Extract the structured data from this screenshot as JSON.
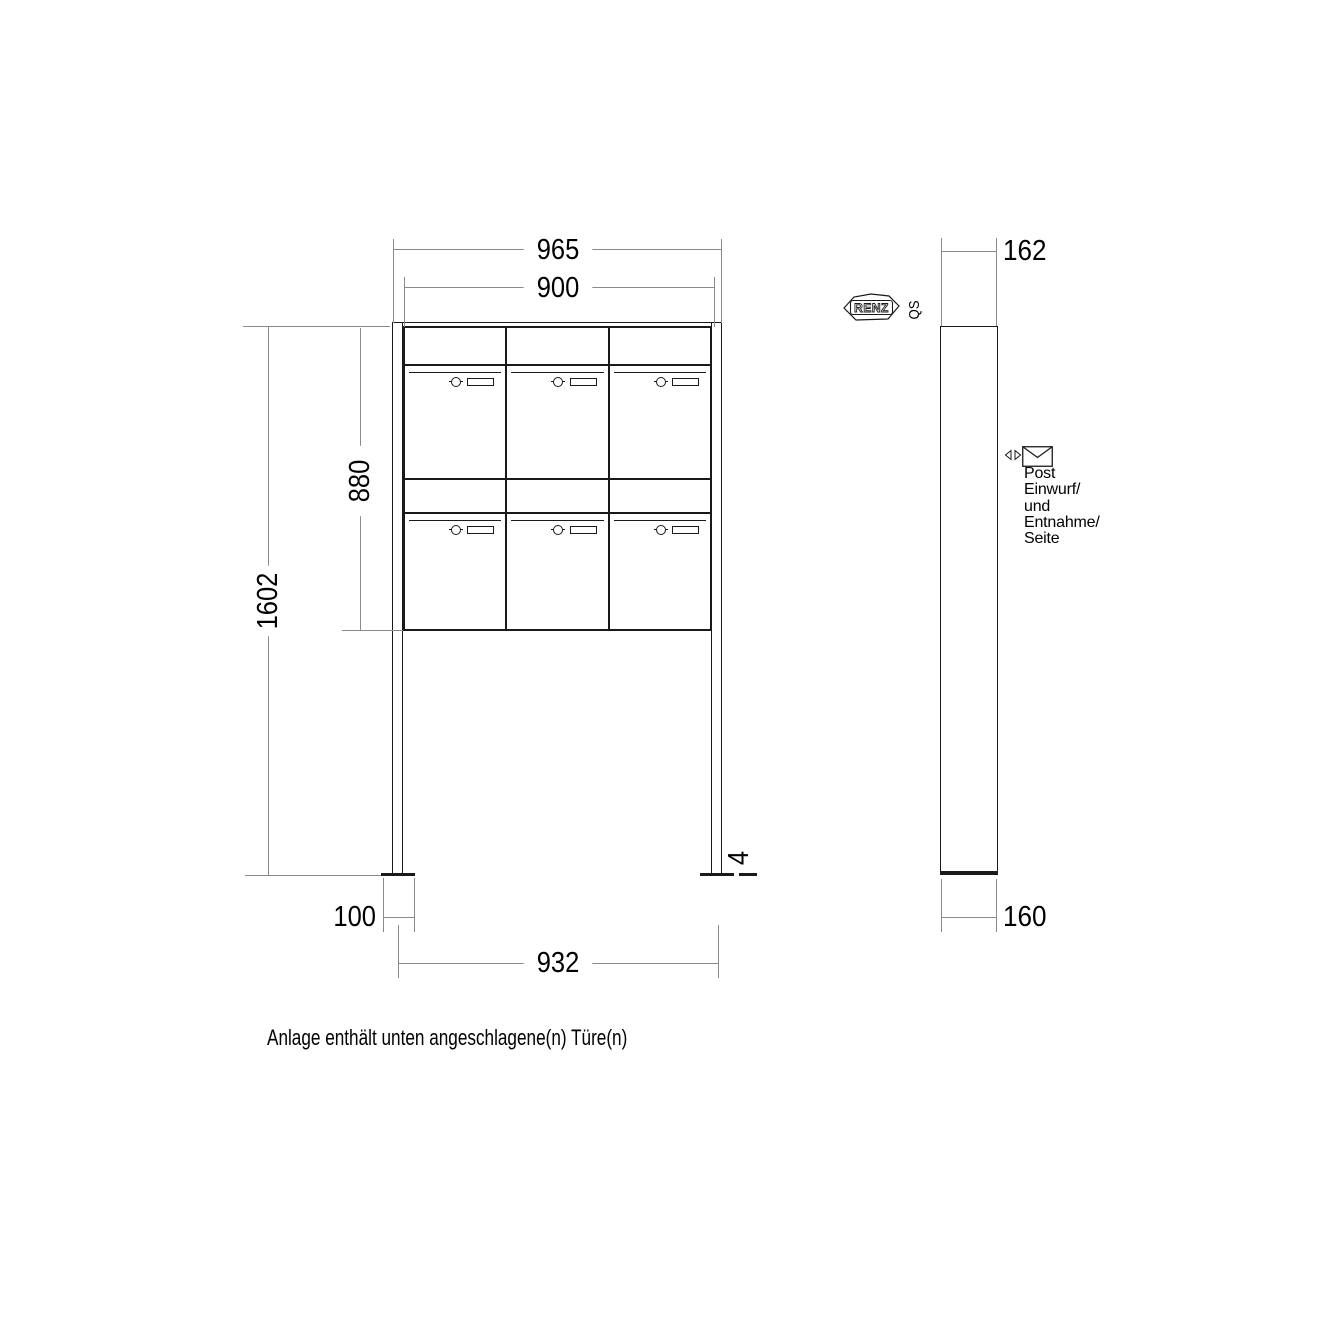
{
  "front_view": {
    "dim_outer_width": "965",
    "dim_body_width": "900",
    "dim_body_height": "880",
    "dim_total_height": "1602",
    "dim_foot_width": "100",
    "dim_foot_spacing": "932",
    "dim_baseplate_gap": "4",
    "compartments": {
      "rows": 2,
      "columns": 3,
      "count": 6
    }
  },
  "side_view": {
    "dim_top_depth": "162",
    "dim_bottom_depth": "160",
    "brand_logo": "RENZ",
    "qs_mark": "QS",
    "service_label": {
      "line1": "Post",
      "line2": "Einwurf/",
      "line3": "und",
      "line4": "Entnahme/",
      "line5": "Seite"
    }
  },
  "note": "Anlage enthält unten angeschlagene(n) Türe(n)",
  "icons": {
    "lock": "cylinder-lock-icon",
    "nameplate": "name-plate",
    "envelope": "envelope-icon",
    "arrows": "left-right-arrow-icon"
  },
  "colors": {
    "object_line": "#1a1a1a",
    "dimension_line": "#8a8a8a",
    "text": "#000000",
    "background": "#ffffff"
  }
}
